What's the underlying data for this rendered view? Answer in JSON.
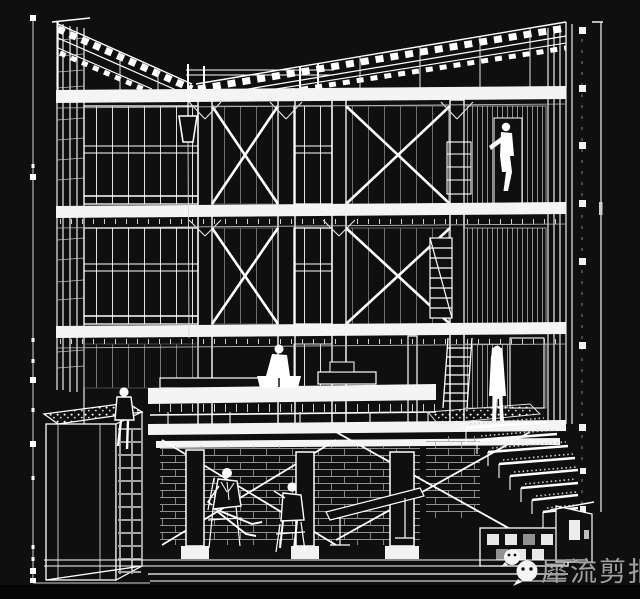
{
  "meta": {
    "description": "White wireframe sectional perspective of a multi-storey timber-frame building with figures, on near-black background"
  },
  "colors": {
    "background": "#0f0f0f",
    "line": "#ffffff",
    "muted_line": "#bdbdbd",
    "watermark_text": "#a2a2a2",
    "bottom_bar": "#050505"
  },
  "watermark": {
    "text": "犀流剪报",
    "logo": "wechat-icon"
  }
}
